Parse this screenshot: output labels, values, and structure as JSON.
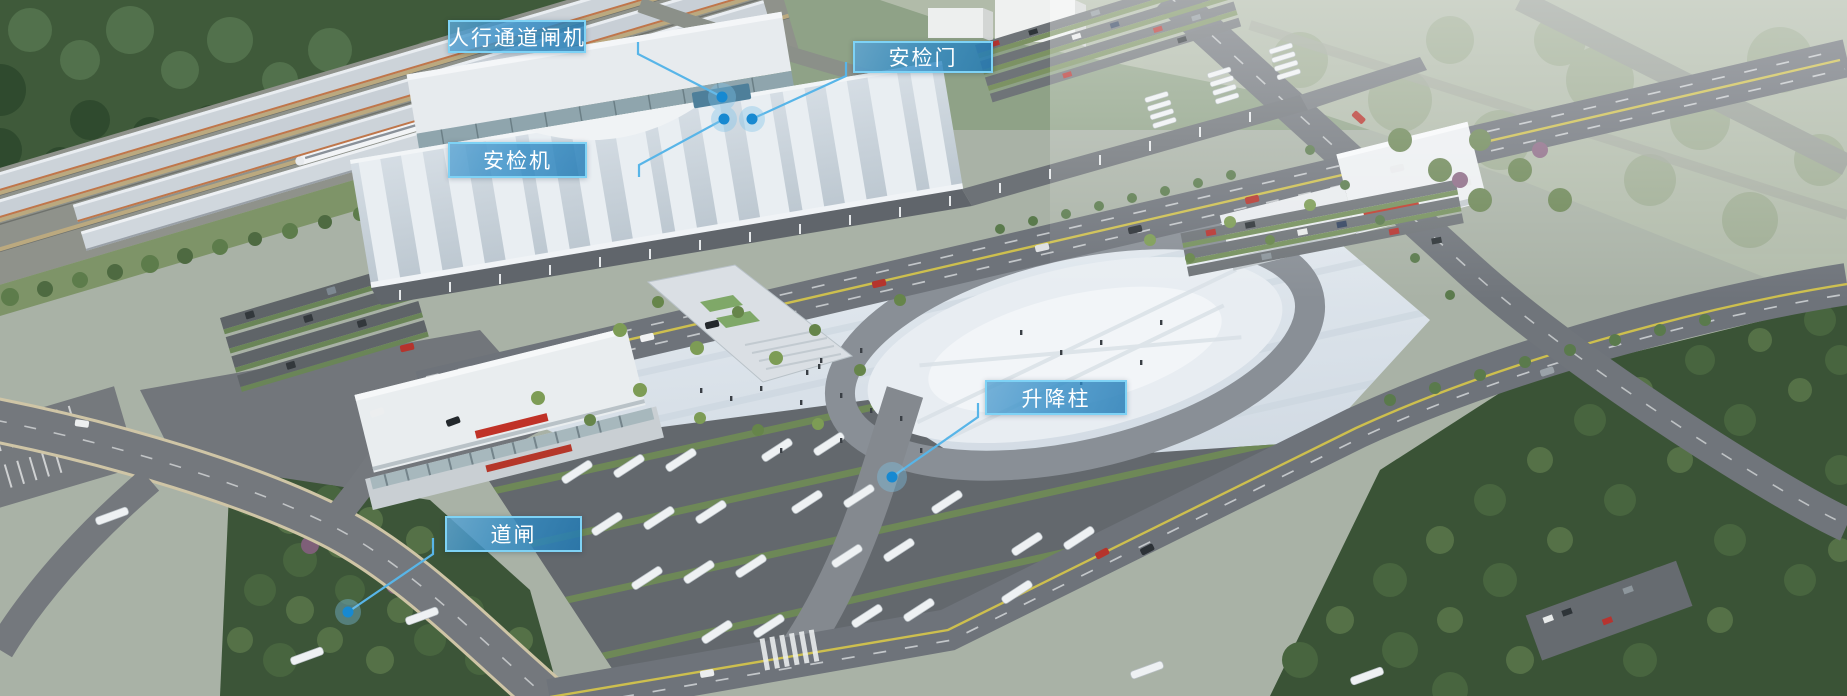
{
  "callouts": [
    {
      "id": "pedestrian-turnstile",
      "label": "人行通道闸机"
    },
    {
      "id": "security-door",
      "label": "安检门"
    },
    {
      "id": "security-scanner",
      "label": "安检机"
    },
    {
      "id": "lifting-bollard",
      "label": "升降柱"
    },
    {
      "id": "road-barrier",
      "label": "道闸"
    }
  ],
  "colors": {
    "callout_bg": "#2484c2",
    "callout_border": "#7ed2f5",
    "leader_line": "#58b5e8",
    "marker_dot": "#1789d1",
    "marker_halo": "#7fc4ea"
  }
}
